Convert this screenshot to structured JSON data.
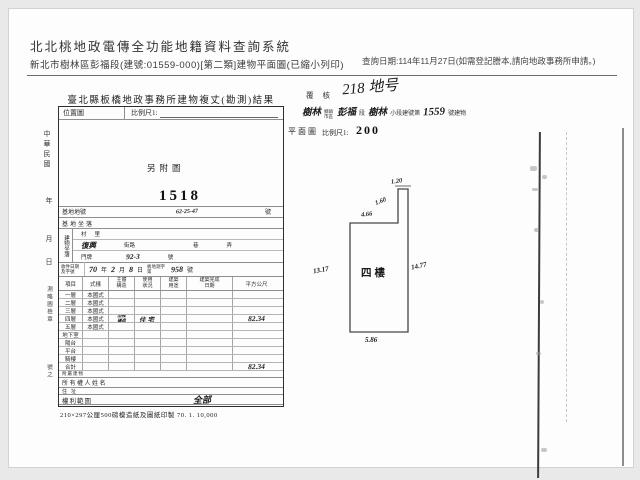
{
  "header": {
    "system_title": "北北桃地政電傳全功能地籍資料查詢系統",
    "subtitle": "新北市樹林區彭福段(建號:01559-000)[第二類]建物平面圖(已縮小列印)",
    "query_date": "查詢日期:114年11月27日(如需登記謄本,請向地政事務所申請。)"
  },
  "form": {
    "title": "臺北縣板橋地政事務所建物複丈(勘測)結果",
    "location": {
      "label": "位置圖",
      "scale_label": "比例尺1:",
      "note": "另附圖",
      "number": "1518"
    },
    "fields": {
      "site_no_label": "基地地號",
      "site_no": "62-25-47",
      "site_no_suffix": "號",
      "site_loc_label": "基地坐落",
      "bldg_loc_label": "建物坐落",
      "village_label": "村里",
      "street_value": "復興",
      "street_label": "街路",
      "lane_label": "巷",
      "alley_label": "弄",
      "door_label": "門牌",
      "door_no": "92-3",
      "door_suffix": "號",
      "receipt_label": "收件日期及字號",
      "receipt": {
        "year": "70",
        "year_unit": "年",
        "month": "2",
        "month_unit": "月",
        "day": "8",
        "day_unit": "日",
        "word": "板地測字第",
        "no": "958",
        "no_unit": "號"
      }
    },
    "table": {
      "columns": [
        "項目",
        "式樣",
        "主體構造",
        "使用狀況",
        "建築用途",
        "建築完成日期",
        "平方公尺"
      ],
      "rows": [
        {
          "item": "一層",
          "style": "本國式",
          "struct": "",
          "use": "",
          "area": ""
        },
        {
          "item": "二層",
          "style": "本國式",
          "struct": "",
          "use": "",
          "area": ""
        },
        {
          "item": "三層",
          "style": "本國式",
          "struct": "",
          "use": "",
          "area": ""
        },
        {
          "item": "四層",
          "style": "本國式",
          "struct": "加強磚造",
          "use": "住宅",
          "area": "82.34"
        },
        {
          "item": "五層",
          "style": "本國式",
          "struct": "",
          "use": "",
          "area": ""
        },
        {
          "item": "地下室",
          "style": "",
          "struct": "",
          "use": "",
          "area": ""
        },
        {
          "item": "陽台",
          "style": "",
          "struct": "",
          "use": "",
          "area": ""
        },
        {
          "item": "平台",
          "style": "",
          "struct": "",
          "use": "",
          "area": ""
        },
        {
          "item": "騎樓",
          "style": "",
          "struct": "",
          "use": "",
          "area": ""
        },
        {
          "item": "合計",
          "style": "",
          "struct": "",
          "use": "",
          "area": "82.34"
        }
      ],
      "append_label": "附屬建物",
      "owner_label": "所有權人姓名",
      "address_label": "住址",
      "rights_label": "權利範圍",
      "rights_value": "全部"
    },
    "footer_note": "210×297公厘500磅模造紙及圖紙印製 70. 1. 10,000",
    "margin_items": [
      "中華民國",
      "年",
      "月",
      "日",
      "測略圖檢章",
      "號之"
    ]
  },
  "plan_doc": {
    "review_label": "覆核",
    "review_note": "218 地号",
    "title_line": {
      "town": "樹林",
      "town_unit": "鄉鎮市區",
      "section": "彭福",
      "section_unit": "段",
      "subsection": "樹林",
      "subsection_unit": "小段建號第",
      "bldg_no": "1559",
      "bldg_no_unit": "號建物"
    },
    "plan_label": "平面圖",
    "scale_label": "比例尺1:",
    "scale_value": "200",
    "floor_label": "四樓",
    "dimensions": {
      "top_width": "1.20",
      "notch_height": "1.60",
      "upper_width": "4.66",
      "left_height": "13.17",
      "right_height": "14.77",
      "bottom_width": "5.86"
    }
  }
}
